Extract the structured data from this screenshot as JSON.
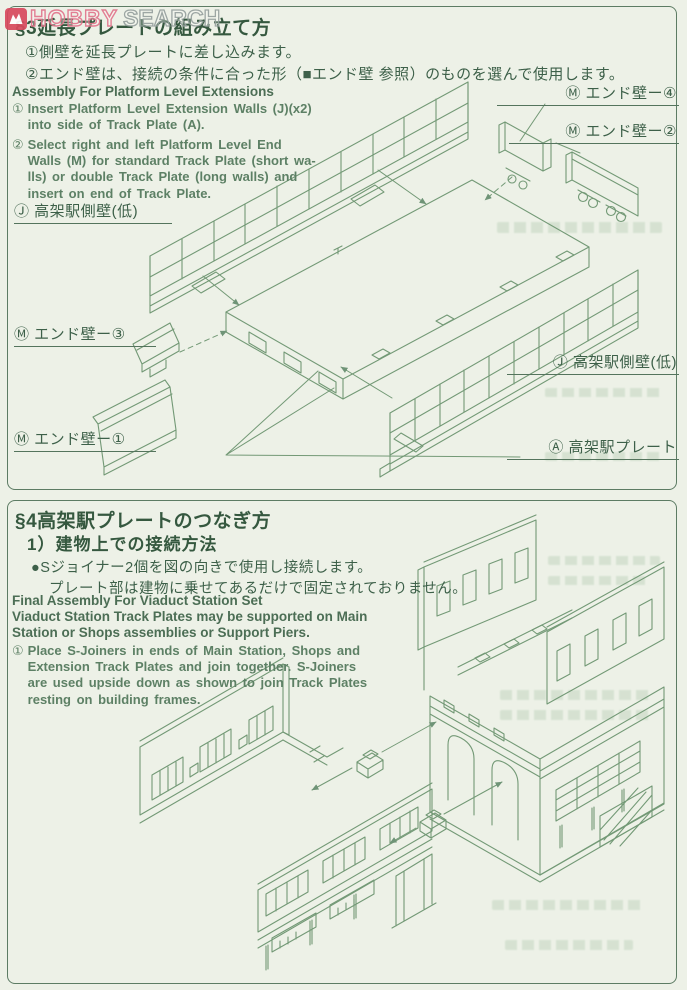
{
  "watermark": {
    "hobby": "HOBBY",
    "search": "SEARCH"
  },
  "colors": {
    "paper": "#edf1e7",
    "line_art": "#739976",
    "ink": "#3d6049",
    "border": "#5d7c64",
    "logo_red": "#d8495e",
    "logo_pink": "#e2758c",
    "logo_gray": "#96a09e"
  },
  "section3": {
    "title": "§3延長プレートの組み立て方",
    "ja_step1": "①側壁を延長プレートに差し込みます。",
    "ja_step2": "②エンド壁は、接続の条件に合った形（■エンド壁 参照）のものを選んで使用します。",
    "en_heading": "Assembly For Platform Level Extensions",
    "en_step1_num": "①",
    "en_step1_l1": "Insert Platform Level Extension Walls (J)(x2)",
    "en_step1_l2": "into side of Track Plate (A).",
    "en_step2_num": "②",
    "en_step2_l1": "Select right and left Platform Level End",
    "en_step2_l2": "Walls (M) for standard Track Plate (short wa-",
    "en_step2_l3": "lls) or double Track Plate (long walls) and",
    "en_step2_l4": "insert on end of Track Plate.",
    "labels": {
      "end_wall_4": "Ⓜ エンド壁ー④",
      "end_wall_2": "Ⓜ エンド壁ー②",
      "side_wall_left": "Ⓙ 高架駅側壁(低)",
      "end_wall_3": "Ⓜ エンド壁ー③",
      "end_wall_1": "Ⓜ エンド壁ー①",
      "side_wall_right": "Ⓙ 高架駅側壁(低)",
      "track_plate": "Ⓐ 高架駅プレート"
    }
  },
  "section4": {
    "title": "§4高架駅プレートのつなぎ方",
    "subtitle": "1）建物上での接続方法",
    "bullet": "●Sジョイナー2個を図の向きで使用し接続します。",
    "note": "プレート部は建物に乗せてあるだけで固定されておりません。",
    "en_heading": "Final Assembly For Viaduct Station Set",
    "en_sub1": "Viaduct Station Track Plates may be supported on Main",
    "en_sub2": "Station or Shops assemblies or Support Piers.",
    "en_step1_num": "①",
    "en_step1_l1": "Place S-Joiners in ends of Main Station, Shops and",
    "en_step1_l2": "Extension Track Plates and join together. S-Joiners",
    "en_step1_l3": "are used upside down as shown to join Track Plates",
    "en_step1_l4": "resting on building frames."
  }
}
